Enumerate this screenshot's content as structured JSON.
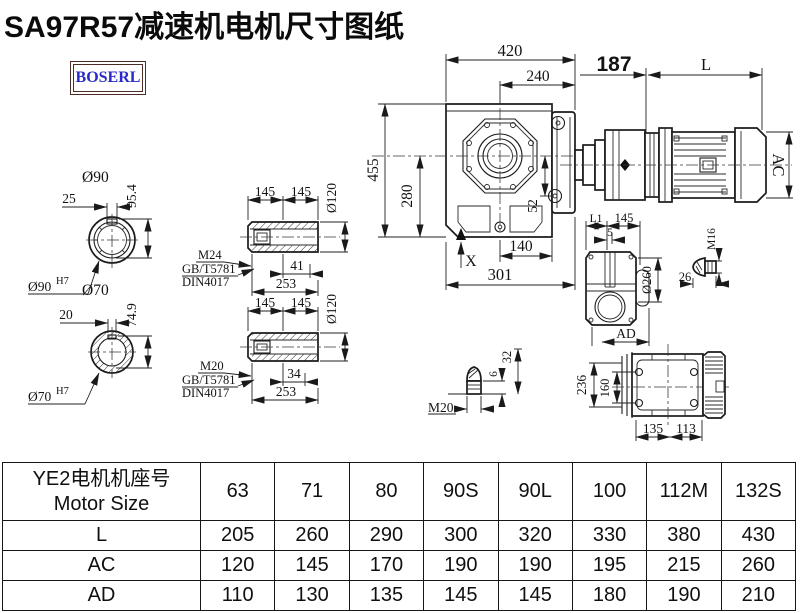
{
  "title": "SA97R57减速机电机尺寸图纸",
  "logo": "BOSERL",
  "colors": {
    "title": "#0b0b0b",
    "logo_text": "#2a2ac6",
    "logo_border": "#4d2d26",
    "line": "#1b1b1b"
  },
  "drawing": {
    "front": {
      "w420": "420",
      "w240": "240",
      "w187": "187",
      "wL": "L",
      "h455": "455",
      "h280": "280",
      "d52": "52",
      "w140": "140",
      "x_mark": "X",
      "w301": "301",
      "ac": "AC"
    },
    "shaft_a": {
      "dia": "Ø90",
      "key": "25",
      "h": "95.4",
      "bore": "Ø90",
      "bore_sup": "H7"
    },
    "shaft_b": {
      "dia": "Ø70",
      "key": "20",
      "h": "74.9",
      "bore": "Ø70",
      "bore_sup": "H7"
    },
    "hollow_a": {
      "l145a": "145",
      "l145b": "145",
      "dia": "Ø120",
      "key_len": "41",
      "total": "253",
      "thread": "M24",
      "std1": "GB/T5781",
      "std2": "DIN4017"
    },
    "hollow_b": {
      "l145a": "145",
      "l145b": "145",
      "dia": "Ø120",
      "key_len": "34",
      "total": "253",
      "thread": "M20",
      "std1": "GB/T5781",
      "std2": "DIN4017"
    },
    "side": {
      "l1": "L1",
      "w145": "145",
      "w5": "5",
      "dia260": "Ø260",
      "ad": "AD",
      "m16": "M16",
      "len26": "26"
    },
    "bolt_m20": {
      "h32": "32",
      "h6": "6",
      "m20": "M20"
    },
    "bottom": {
      "h236": "236",
      "h160": "160",
      "w135": "135",
      "w113": "113"
    }
  },
  "table": {
    "header_col": [
      "YE2电机机座号",
      "Motor Size"
    ],
    "sizes": [
      "63",
      "71",
      "80",
      "90S",
      "90L",
      "100",
      "112M",
      "132S"
    ],
    "rows": [
      {
        "label": "L",
        "values": [
          "205",
          "260",
          "290",
          "300",
          "320",
          "330",
          "380",
          "430"
        ]
      },
      {
        "label": "AC",
        "values": [
          "120",
          "145",
          "170",
          "190",
          "190",
          "195",
          "215",
          "260"
        ]
      },
      {
        "label": "AD",
        "values": [
          "110",
          "130",
          "135",
          "145",
          "145",
          "180",
          "190",
          "210"
        ]
      }
    ]
  }
}
